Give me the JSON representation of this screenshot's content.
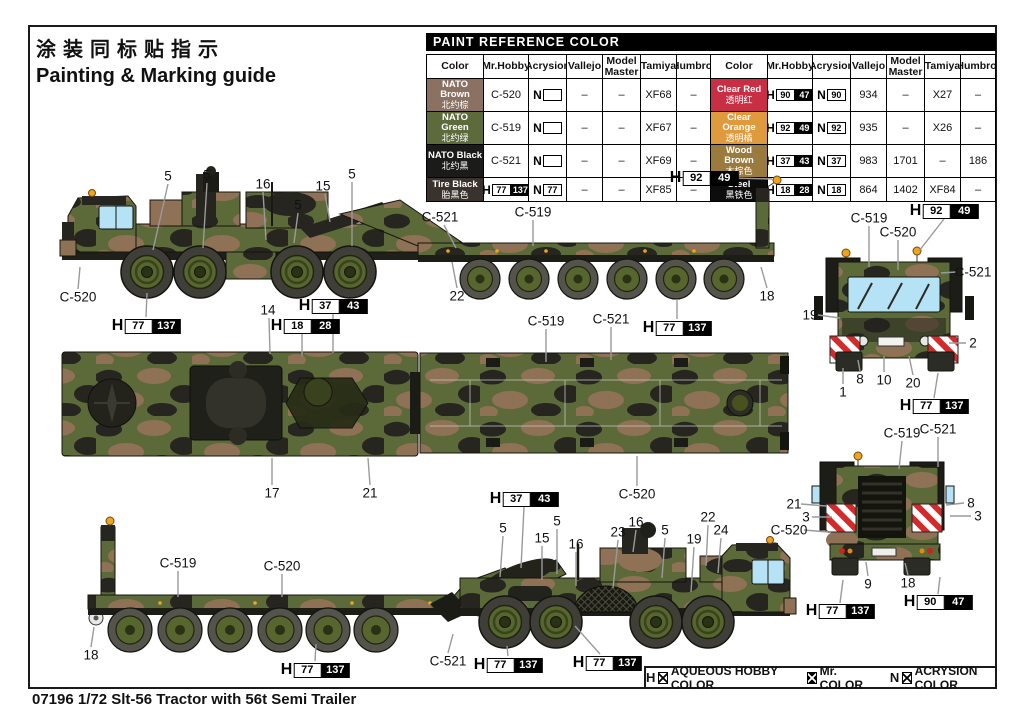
{
  "page": {
    "title_cn": "涂装同标贴指示",
    "title_en": "Painting & Marking guide",
    "footer": "07196 1/72  Slt-56 Tractor with 56t Semi Trailer"
  },
  "palette": {
    "camo_green": "#5c6a39",
    "camo_brown": "#8f7155",
    "camo_black": "#26251f",
    "tire": "#3f3e38",
    "rim": "#57652e",
    "window": "#b5e2f4",
    "beacon": "#f2a31c",
    "hazard_red": "#d22b2b",
    "leader": "#9a9a9a",
    "frame": "#1a1a1a"
  },
  "paint_table": {
    "title": "PAINT  REFERENCE COLOR",
    "headers": [
      "Color",
      "Mr.Hobby",
      "Acrysion",
      "Vallejo",
      "Model Master",
      "Tamiya",
      "Humbrol"
    ],
    "groups": [
      {
        "rows": [
          {
            "en": "NATO Brown",
            "cn": "北约棕",
            "bg": "#8a7162",
            "fg": "#ffffff",
            "cells": [
              {
                "k": "t",
                "v": "C-520"
              },
              {
                "k": "nbox",
                "v": ""
              },
              {
                "k": "t",
                "v": "–"
              },
              {
                "k": "t",
                "v": "–"
              },
              {
                "k": "t",
                "v": "XF68"
              },
              {
                "k": "t",
                "v": "–"
              }
            ]
          },
          {
            "en": "NATO Green",
            "cn": "北约绿",
            "bg": "#5d6b3c",
            "fg": "#ffffff",
            "cells": [
              {
                "k": "t",
                "v": "C-519"
              },
              {
                "k": "nbox",
                "v": ""
              },
              {
                "k": "t",
                "v": "–"
              },
              {
                "k": "t",
                "v": "–"
              },
              {
                "k": "t",
                "v": "XF67"
              },
              {
                "k": "t",
                "v": "–"
              }
            ]
          },
          {
            "en": "NATO Black",
            "cn": "北约黑",
            "bg": "#1b1b19",
            "fg": "#ffffff",
            "cells": [
              {
                "k": "t",
                "v": "C-521"
              },
              {
                "k": "nbox",
                "v": ""
              },
              {
                "k": "t",
                "v": "–"
              },
              {
                "k": "t",
                "v": "–"
              },
              {
                "k": "t",
                "v": "XF69"
              },
              {
                "k": "t",
                "v": "–"
              }
            ]
          },
          {
            "en": "Tire Black",
            "cn": "胎黑色",
            "bg": "#3a332d",
            "fg": "#ffffff",
            "cells": [
              {
                "k": "hbox",
                "w": "77",
                "b": "137"
              },
              {
                "k": "nbox",
                "v": "77"
              },
              {
                "k": "t",
                "v": "–"
              },
              {
                "k": "t",
                "v": "–"
              },
              {
                "k": "t",
                "v": "XF85"
              },
              {
                "k": "t",
                "v": "–"
              }
            ]
          }
        ]
      },
      {
        "rows": [
          {
            "en": "Clear Red",
            "cn": "透明红",
            "bg": "#c82f45",
            "fg": "#ffffff",
            "cells": [
              {
                "k": "hbox",
                "w": "90",
                "b": "47"
              },
              {
                "k": "nbox",
                "v": "90"
              },
              {
                "k": "t",
                "v": "934"
              },
              {
                "k": "t",
                "v": "–"
              },
              {
                "k": "t",
                "v": "X27"
              },
              {
                "k": "t",
                "v": "–"
              }
            ]
          },
          {
            "en": "Clear Orange",
            "cn": "透明橘",
            "bg": "#df9a3d",
            "fg": "#ffffff",
            "cells": [
              {
                "k": "hbox",
                "w": "92",
                "b": "49"
              },
              {
                "k": "nbox",
                "v": "92"
              },
              {
                "k": "t",
                "v": "935"
              },
              {
                "k": "t",
                "v": "–"
              },
              {
                "k": "t",
                "v": "X26"
              },
              {
                "k": "t",
                "v": "–"
              }
            ]
          },
          {
            "en": "Wood Brown",
            "cn": "木棕色",
            "bg": "#9a7a3d",
            "fg": "#ffffff",
            "cells": [
              {
                "k": "hbox",
                "w": "37",
                "b": "43"
              },
              {
                "k": "nbox",
                "v": "37"
              },
              {
                "k": "t",
                "v": "983"
              },
              {
                "k": "t",
                "v": "1701"
              },
              {
                "k": "t",
                "v": "–"
              },
              {
                "k": "t",
                "v": "186"
              }
            ]
          },
          {
            "en": "Steel",
            "cn": "黑铁色",
            "bg": "#0d0d0d",
            "fg": "#ffffff",
            "cells": [
              {
                "k": "hbox",
                "w": "18",
                "b": "28"
              },
              {
                "k": "nbox",
                "v": "18"
              },
              {
                "k": "t",
                "v": "864"
              },
              {
                "k": "t",
                "v": "1402"
              },
              {
                "k": "t",
                "v": "XF84"
              },
              {
                "k": "t",
                "v": "–"
              }
            ]
          }
        ]
      }
    ]
  },
  "legend": {
    "items": [
      {
        "prefix": "H",
        "box": "white",
        "label": "AQUEOUS HOBBY COLOR"
      },
      {
        "prefix": "",
        "box": "black",
        "label": "Mr. COLOR"
      },
      {
        "prefix": "N",
        "box": "white",
        "label": "ACRYSION COLOR"
      }
    ]
  },
  "illustration": {
    "callouts": [
      {
        "kind": "num",
        "text": "5",
        "x": 168,
        "y": 176,
        "line": [
          168,
          184,
          153,
          250
        ]
      },
      {
        "kind": "num",
        "text": "5",
        "x": 207,
        "y": 175,
        "line": [
          207,
          183,
          203,
          248
        ]
      },
      {
        "kind": "num",
        "text": "16",
        "x": 263,
        "y": 184,
        "line": [
          263,
          192,
          266,
          240
        ]
      },
      {
        "kind": "num",
        "text": "15",
        "x": 323,
        "y": 186,
        "line": [
          325,
          194,
          330,
          222
        ]
      },
      {
        "kind": "num",
        "text": "5",
        "x": 352,
        "y": 174,
        "line": [
          352,
          182,
          352,
          246
        ]
      },
      {
        "kind": "num",
        "text": "5",
        "x": 298,
        "y": 205,
        "line": [
          298,
          213,
          294,
          243
        ]
      },
      {
        "kind": "ref",
        "text": "C-521",
        "x": 440,
        "y": 217,
        "line": [
          444,
          225,
          456,
          248
        ]
      },
      {
        "kind": "ref",
        "text": "C-519",
        "x": 533,
        "y": 212,
        "line": [
          533,
          220,
          533,
          246
        ]
      },
      {
        "kind": "marker",
        "white": "92",
        "black": "49",
        "x": 704,
        "y": 178,
        "line": [
          733,
          178,
          772,
          179
        ]
      },
      {
        "kind": "ref",
        "text": "C-520",
        "x": 78,
        "y": 297,
        "line": [
          78,
          289,
          80,
          267
        ]
      },
      {
        "kind": "num",
        "text": "22",
        "x": 457,
        "y": 296,
        "line": [
          457,
          288,
          452,
          262
        ]
      },
      {
        "kind": "num",
        "text": "18",
        "x": 767,
        "y": 296,
        "line": [
          767,
          288,
          761,
          267
        ]
      },
      {
        "kind": "marker",
        "white": "77",
        "black": "137",
        "x": 146,
        "y": 326,
        "line": [
          146,
          317,
          147,
          293
        ]
      },
      {
        "kind": "num",
        "text": "14",
        "x": 268,
        "y": 310,
        "line": [
          269,
          318,
          270,
          354
        ]
      },
      {
        "kind": "marker",
        "white": "37",
        "black": "43",
        "x": 333,
        "y": 306,
        "line": [
          333,
          314,
          333,
          353
        ]
      },
      {
        "kind": "marker",
        "white": "18",
        "black": "28",
        "x": 305,
        "y": 326,
        "line": [
          302,
          334,
          302,
          356
        ]
      },
      {
        "kind": "num",
        "text": "17",
        "x": 272,
        "y": 493,
        "line": [
          272,
          485,
          272,
          458
        ]
      },
      {
        "kind": "num",
        "text": "21",
        "x": 370,
        "y": 493,
        "line": [
          370,
          485,
          368,
          458
        ]
      },
      {
        "kind": "ref",
        "text": "C-519",
        "x": 546,
        "y": 321,
        "line": [
          546,
          329,
          546,
          362
        ]
      },
      {
        "kind": "ref",
        "text": "C-521",
        "x": 611,
        "y": 319,
        "line": [
          611,
          327,
          611,
          360
        ]
      },
      {
        "kind": "marker",
        "white": "77",
        "black": "137",
        "x": 677,
        "y": 328,
        "line": [
          677,
          319,
          677,
          299
        ]
      },
      {
        "kind": "ref",
        "text": "C-520",
        "x": 637,
        "y": 494,
        "line": [
          637,
          486,
          637,
          456
        ]
      },
      {
        "kind": "marker",
        "white": "37",
        "black": "43",
        "x": 524,
        "y": 499,
        "line": [
          524,
          507,
          521,
          568
        ]
      },
      {
        "kind": "num",
        "text": "18",
        "x": 91,
        "y": 655,
        "line": [
          91,
          647,
          94,
          627
        ]
      },
      {
        "kind": "ref",
        "text": "C-519",
        "x": 178,
        "y": 563,
        "line": [
          178,
          571,
          178,
          597
        ]
      },
      {
        "kind": "ref",
        "text": "C-520",
        "x": 282,
        "y": 566,
        "line": [
          282,
          574,
          282,
          597
        ]
      },
      {
        "kind": "marker",
        "white": "77",
        "black": "137",
        "x": 315,
        "y": 670,
        "line": [
          315,
          661,
          316,
          644
        ]
      },
      {
        "kind": "ref",
        "text": "C-521",
        "x": 448,
        "y": 661,
        "line": [
          448,
          653,
          453,
          634
        ]
      },
      {
        "kind": "marker",
        "white": "77",
        "black": "137",
        "x": 508,
        "y": 665,
        "line": [
          508,
          656,
          507,
          646
        ]
      },
      {
        "kind": "marker",
        "white": "77",
        "black": "137",
        "x": 607,
        "y": 663,
        "line": [
          600,
          654,
          575,
          626
        ]
      },
      {
        "kind": "num",
        "text": "5",
        "x": 503,
        "y": 528,
        "line": [
          503,
          536,
          500,
          577
        ]
      },
      {
        "kind": "num",
        "text": "15",
        "x": 542,
        "y": 538,
        "line": [
          542,
          546,
          542,
          580
        ]
      },
      {
        "kind": "num",
        "text": "5",
        "x": 557,
        "y": 521,
        "line": [
          557,
          529,
          557,
          574
        ]
      },
      {
        "kind": "num",
        "text": "16",
        "x": 576,
        "y": 544,
        "line": [
          576,
          552,
          576,
          586
        ]
      },
      {
        "kind": "num",
        "text": "23",
        "x": 618,
        "y": 532,
        "line": [
          618,
          540,
          613,
          588
        ]
      },
      {
        "kind": "num",
        "text": "16",
        "x": 636,
        "y": 522,
        "line": [
          636,
          530,
          633,
          552
        ]
      },
      {
        "kind": "num",
        "text": "5",
        "x": 665,
        "y": 530,
        "line": [
          665,
          538,
          662,
          578
        ]
      },
      {
        "kind": "num",
        "text": "19",
        "x": 694,
        "y": 539,
        "line": [
          694,
          547,
          691,
          592
        ]
      },
      {
        "kind": "num",
        "text": "22",
        "x": 708,
        "y": 517,
        "line": [
          708,
          525,
          706,
          566
        ]
      },
      {
        "kind": "num",
        "text": "24",
        "x": 721,
        "y": 530,
        "line": [
          721,
          538,
          718,
          573
        ]
      },
      {
        "kind": "ref",
        "text": "C-519",
        "x": 869,
        "y": 218,
        "line": [
          869,
          226,
          869,
          267
        ]
      },
      {
        "kind": "ref",
        "text": "C-520",
        "x": 898,
        "y": 232,
        "line": [
          898,
          240,
          898,
          270
        ]
      },
      {
        "kind": "marker",
        "white": "92",
        "black": "49",
        "x": 944,
        "y": 211,
        "line": [
          944,
          219,
          919,
          251
        ]
      },
      {
        "kind": "ref",
        "text": "C-521",
        "x": 973,
        "y": 272,
        "line": [
          956,
          272,
          941,
          273
        ]
      },
      {
        "kind": "num",
        "text": "19",
        "x": 810,
        "y": 315,
        "line": [
          818,
          315,
          840,
          318
        ]
      },
      {
        "kind": "num",
        "text": "2",
        "x": 973,
        "y": 343,
        "line": [
          966,
          343,
          949,
          343
        ]
      },
      {
        "kind": "num",
        "text": "1",
        "x": 843,
        "y": 392,
        "line": [
          843,
          384,
          843,
          368
        ]
      },
      {
        "kind": "num",
        "text": "8",
        "x": 860,
        "y": 379,
        "line": [
          860,
          371,
          858,
          360
        ]
      },
      {
        "kind": "num",
        "text": "10",
        "x": 884,
        "y": 380,
        "line": [
          884,
          372,
          884,
          356
        ]
      },
      {
        "kind": "num",
        "text": "20",
        "x": 913,
        "y": 383,
        "line": [
          913,
          375,
          909,
          356
        ]
      },
      {
        "kind": "marker",
        "white": "77",
        "black": "137",
        "x": 934,
        "y": 406,
        "line": [
          934,
          398,
          938,
          373
        ]
      },
      {
        "kind": "ref",
        "text": "C-519",
        "x": 902,
        "y": 433,
        "line": [
          902,
          441,
          899,
          469
        ]
      },
      {
        "kind": "ref",
        "text": "C-521",
        "x": 938,
        "y": 429,
        "line": [
          938,
          437,
          938,
          467
        ]
      },
      {
        "kind": "num",
        "text": "21",
        "x": 794,
        "y": 504,
        "line": [
          801,
          504,
          826,
          506
        ]
      },
      {
        "kind": "num",
        "text": "3",
        "x": 806,
        "y": 517,
        "line": [
          812,
          517,
          832,
          517
        ]
      },
      {
        "kind": "ref",
        "text": "C-520",
        "x": 789,
        "y": 530,
        "line": [
          804,
          530,
          828,
          532
        ]
      },
      {
        "kind": "num",
        "text": "8",
        "x": 971,
        "y": 503,
        "line": [
          964,
          503,
          946,
          505
        ]
      },
      {
        "kind": "num",
        "text": "3",
        "x": 978,
        "y": 516,
        "line": [
          971,
          516,
          950,
          516
        ]
      },
      {
        "kind": "num",
        "text": "9",
        "x": 868,
        "y": 584,
        "line": [
          868,
          576,
          866,
          562
        ]
      },
      {
        "kind": "num",
        "text": "18",
        "x": 908,
        "y": 583,
        "line": [
          908,
          575,
          905,
          563
        ]
      },
      {
        "kind": "marker",
        "white": "77",
        "black": "137",
        "x": 840,
        "y": 611,
        "line": [
          840,
          603,
          843,
          580
        ]
      },
      {
        "kind": "marker",
        "white": "90",
        "black": "47",
        "x": 938,
        "y": 602,
        "line": [
          938,
          594,
          940,
          577
        ]
      }
    ]
  }
}
